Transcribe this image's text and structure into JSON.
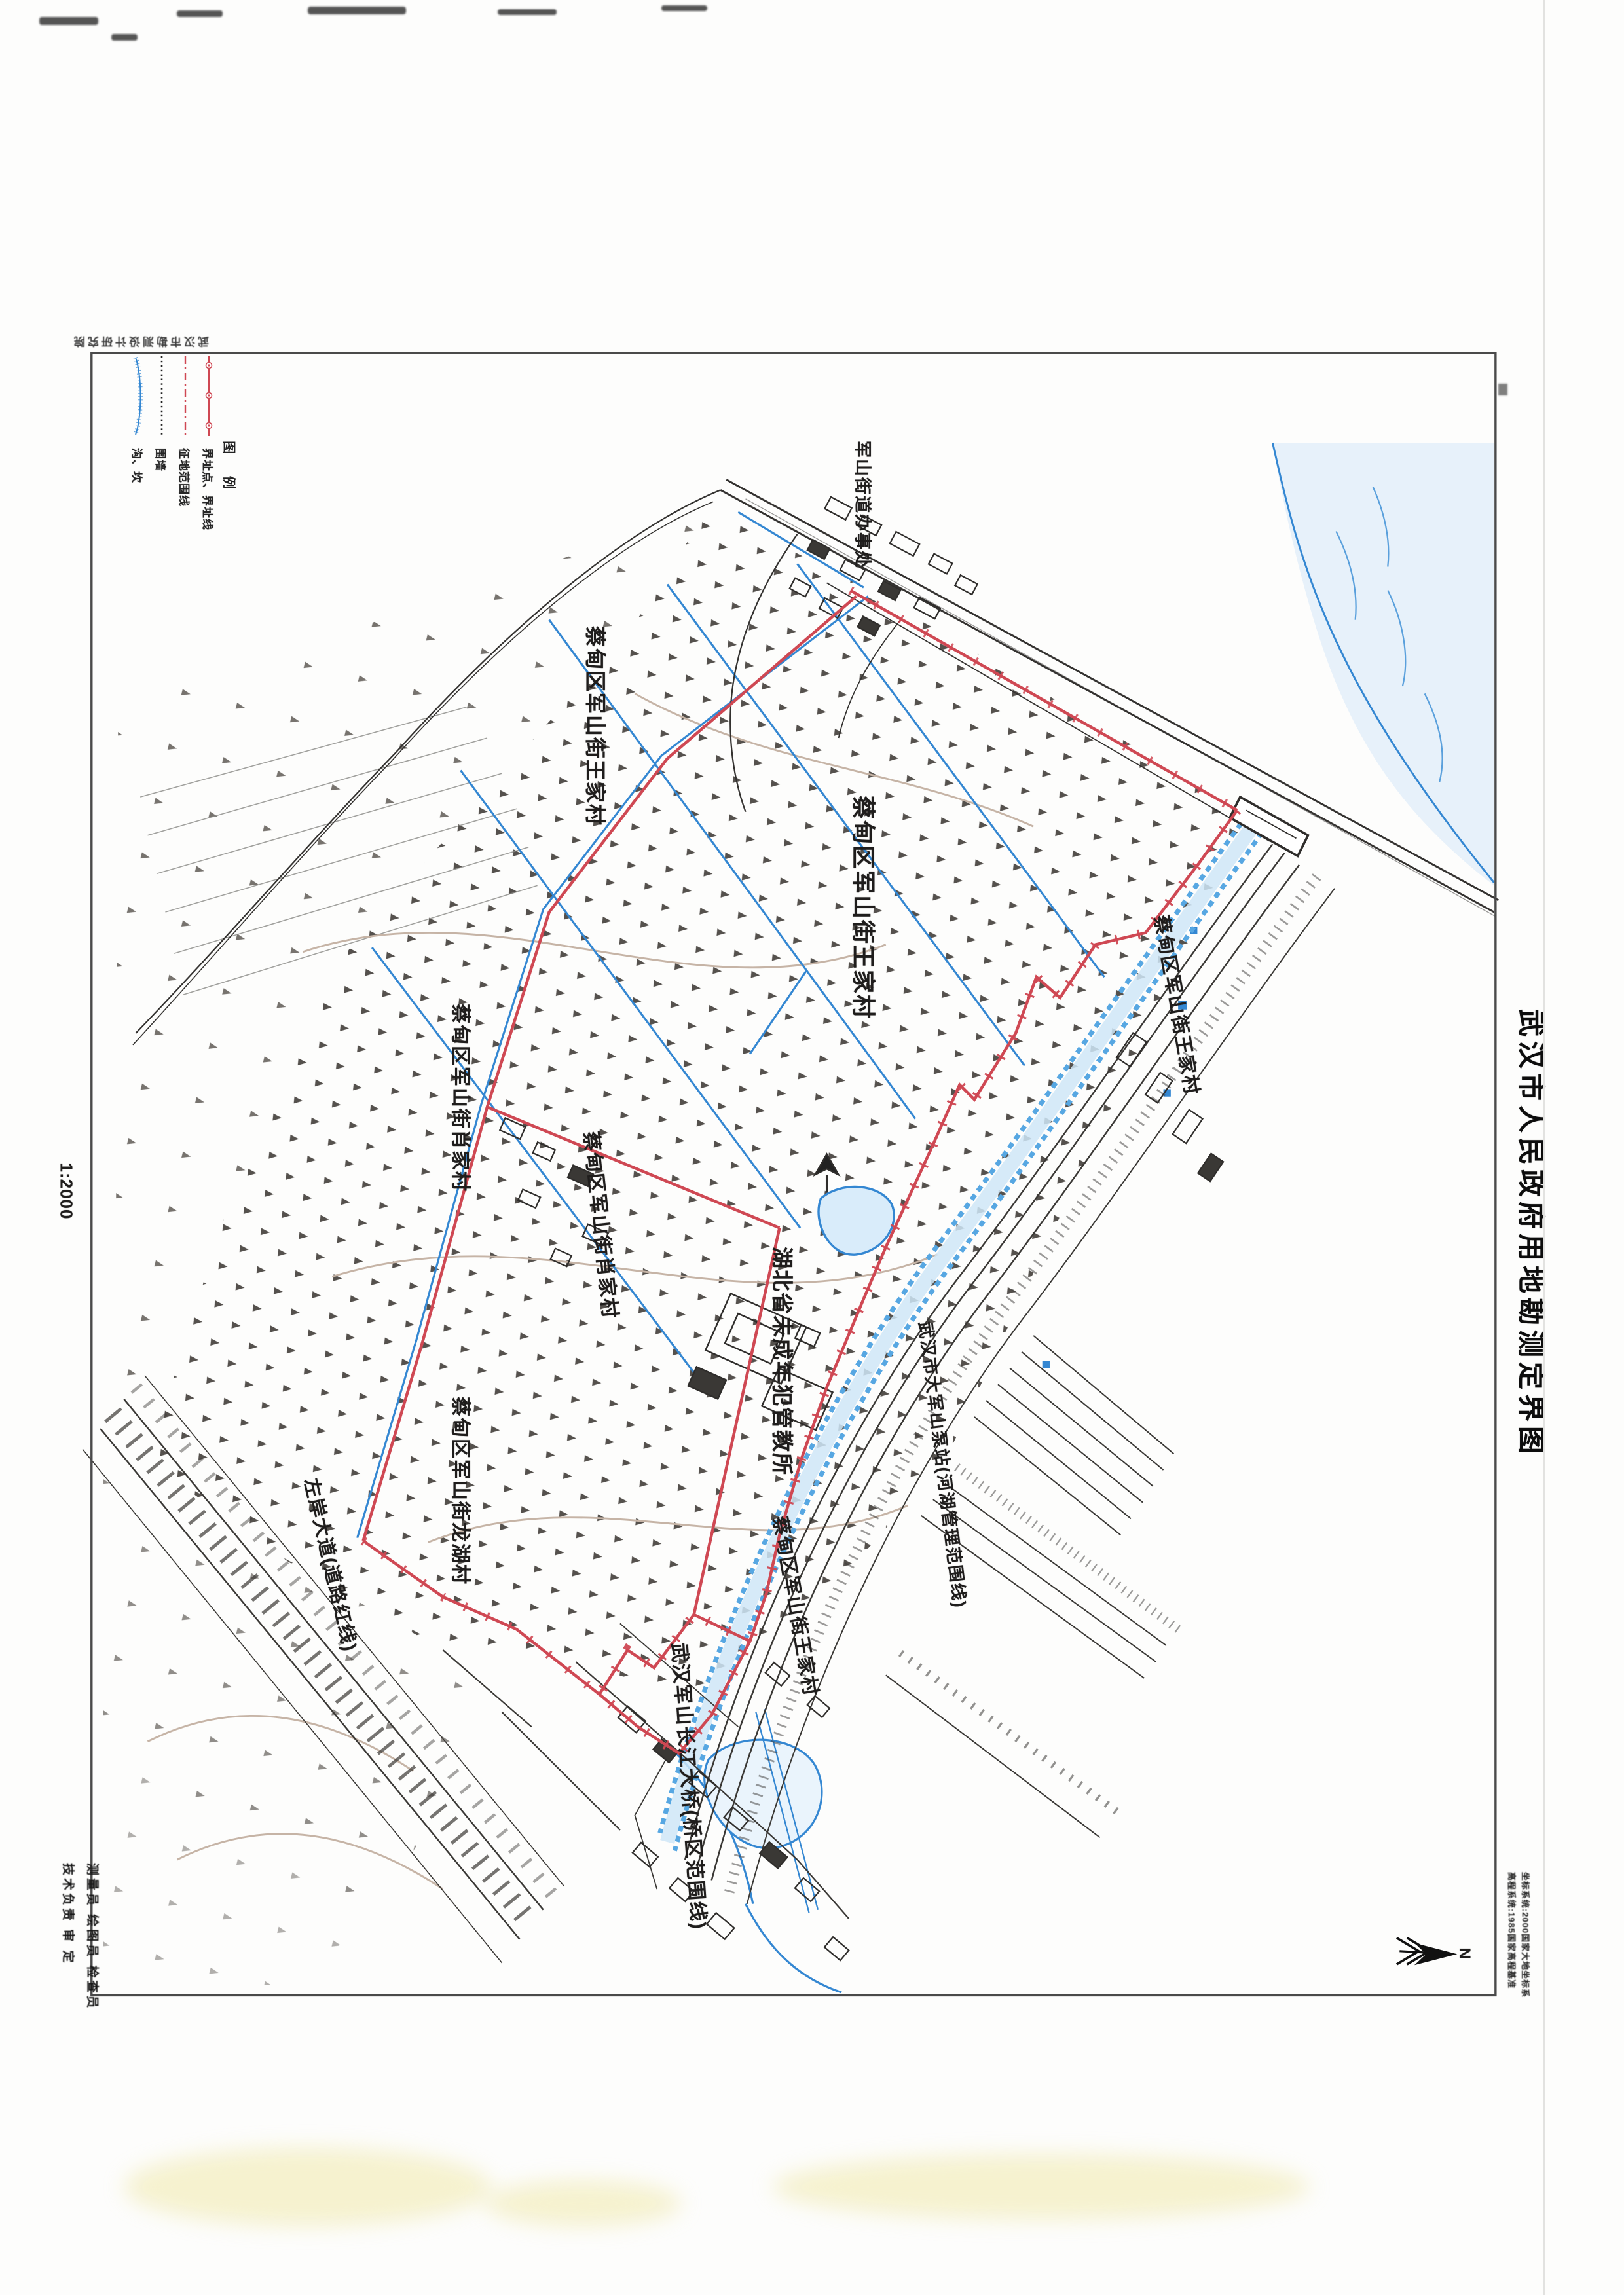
{
  "page": {
    "sheet_title": "武汉市人民政府用地勘测定界图",
    "scale": "1:2000",
    "surveyor_stamp": "武汉市勘测设计研究院",
    "north_label": "N",
    "notes": {
      "line1": "坐标系统:2000国家大地坐标系",
      "line2": "高程系统:1985国家高程基准"
    }
  },
  "legend": {
    "title": "图 例",
    "entries": [
      {
        "symbol": "red-boundary-line-with-points",
        "label": "界址点、界址线"
      },
      {
        "symbol": "red-dash-dot-line",
        "label": "征地范围线"
      },
      {
        "symbol": "black-dotted-line",
        "label": "围墙"
      },
      {
        "symbol": "blue-hachure-line",
        "label": "沟、坎"
      }
    ]
  },
  "signature_block": {
    "line1": "测量员  绘图员  检查员",
    "line2": "技术负责   审 定"
  },
  "map_labels": [
    {
      "id": "wangjiacun-north",
      "text": "蔡甸区军山街王家村"
    },
    {
      "id": "wangjiacun-center",
      "text": "蔡甸区军山街王家村"
    },
    {
      "id": "wangjiacun-levee",
      "text": "蔡甸区军山街王家村"
    },
    {
      "id": "wangjiacun-south",
      "text": "蔡甸区军山街王家村"
    },
    {
      "id": "xiaojiacun-1",
      "text": "蔡甸区军山街肖家村"
    },
    {
      "id": "xiaojiacun-2",
      "text": "蔡甸区军山街肖家村"
    },
    {
      "id": "longhucun",
      "text": "蔡甸区军山街龙湖村"
    },
    {
      "id": "prison",
      "text": "湖北省未成年犯管教所"
    },
    {
      "id": "pump-station",
      "text": "武汉市大军山泵站(河湖管理范围线)"
    },
    {
      "id": "zuoan-avenue",
      "text": "左岸大道(道路红线)"
    },
    {
      "id": "junshan-bridge",
      "text": "武汉军山长江大桥(桥区范围线)"
    },
    {
      "id": "junshan-street",
      "text": "军山街道办事处"
    }
  ]
}
